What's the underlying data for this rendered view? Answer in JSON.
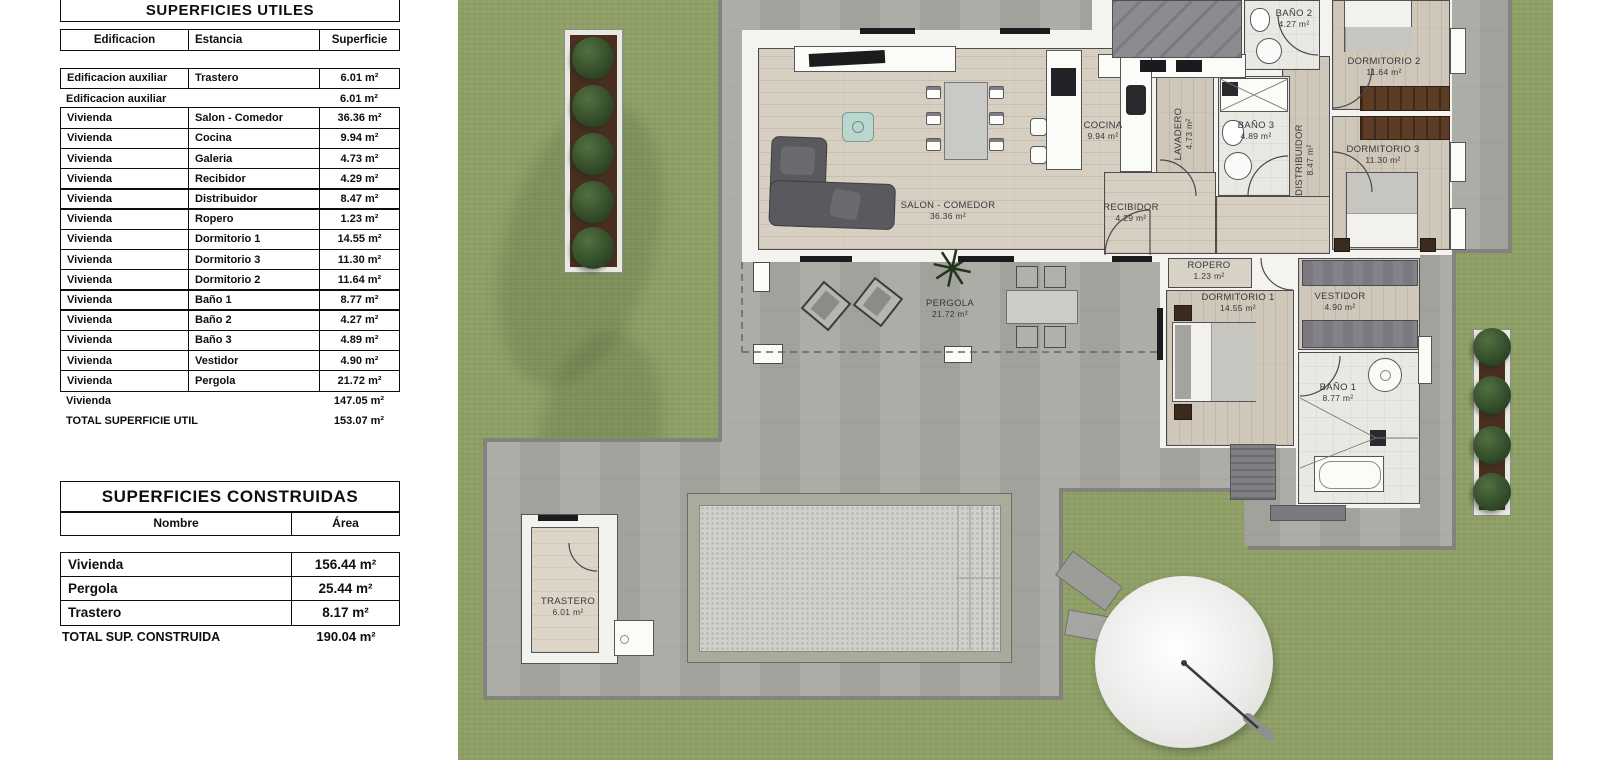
{
  "tables": {
    "utiles": {
      "title": "SUPERFICIES UTILES",
      "col1": "Edificacion",
      "col2": "Estancia",
      "col3": "Superficie",
      "group1": [
        {
          "b": "Edificacion auxiliar",
          "e": "Trastero",
          "s": "6.01 m²"
        }
      ],
      "sub1": {
        "b": "Edificacion auxiliar",
        "s": "6.01 m²"
      },
      "group2": [
        {
          "b": "Vivienda",
          "e": "Salon - Comedor",
          "s": "36.36 m²"
        },
        {
          "b": "Vivienda",
          "e": "Cocina",
          "s": "9.94 m²"
        },
        {
          "b": "Vivienda",
          "e": "Galeria",
          "s": "4.73 m²"
        },
        {
          "b": "Vivienda",
          "e": "Recibidor",
          "s": "4.29 m²"
        },
        {
          "b": "Vivienda",
          "e": "Distribuidor",
          "s": "8.47 m²"
        },
        {
          "b": "Vivienda",
          "e": "Ropero",
          "s": "1.23 m²"
        },
        {
          "b": "Vivienda",
          "e": "Dormitorio 1",
          "s": "14.55 m²"
        },
        {
          "b": "Vivienda",
          "e": "Dormitorio 3",
          "s": "11.30 m²"
        },
        {
          "b": "Vivienda",
          "e": "Dormitorio 2",
          "s": "11.64 m²"
        },
        {
          "b": "Vivienda",
          "e": "Baño 1",
          "s": "8.77 m²"
        },
        {
          "b": "Vivienda",
          "e": "Baño 2",
          "s": "4.27 m²"
        },
        {
          "b": "Vivienda",
          "e": "Baño 3",
          "s": "4.89 m²"
        },
        {
          "b": "Vivienda",
          "e": "Vestidor",
          "s": "4.90 m²"
        },
        {
          "b": "Vivienda",
          "e": "Pergola",
          "s": "21.72 m²"
        }
      ],
      "sub2": {
        "b": "Vivienda",
        "s": "147.05 m²"
      },
      "total": {
        "b": "TOTAL SUPERFICIE UTIL",
        "s": "153.07 m²"
      }
    },
    "construidas": {
      "title": "SUPERFICIES CONSTRUIDAS",
      "col1": "Nombre",
      "col2": "Área",
      "rows": [
        {
          "n": "Vivienda",
          "a": "156.44 m²"
        },
        {
          "n": "Pergola",
          "a": "25.44 m²"
        },
        {
          "n": "Trastero",
          "a": "8.17 m²"
        }
      ],
      "total": {
        "b": "TOTAL SUP. CONSTRUIDA",
        "s": "190.04 m²"
      }
    }
  },
  "plan": {
    "rooms": {
      "salon": {
        "name": "SALON - COMEDOR",
        "area": "36.36 m²"
      },
      "cocina": {
        "name": "COCINA",
        "area": "9.94 m²"
      },
      "recibidor": {
        "name": "RECIBIDOR",
        "area": "4.29 m²"
      },
      "lavadero": {
        "name": "LAVADERO",
        "area": "4.73 m²"
      },
      "distribuidor": {
        "name": "DISTRIBUIDOR",
        "area": "8.47 m²"
      },
      "bano2": {
        "name": "BAÑO 2",
        "area": "4.27 m²"
      },
      "bano3": {
        "name": "BAÑO 3",
        "area": "4.89 m²"
      },
      "dorm2": {
        "name": "DORMITORIO 2",
        "area": "11.64 m²"
      },
      "dorm3": {
        "name": "DORMITORIO 3",
        "area": "11.30 m²"
      },
      "ropero": {
        "name": "ROPERO",
        "area": "1.23 m²"
      },
      "dorm1": {
        "name": "DORMITORIO 1",
        "area": "14.55 m²"
      },
      "vestidor": {
        "name": "VESTIDOR",
        "area": "4.90 m²"
      },
      "bano1": {
        "name": "BAÑO 1",
        "area": "8.77 m²"
      },
      "pergola": {
        "name": "PERGOLA",
        "area": "21.72 m²"
      },
      "trastero": {
        "name": "TRASTERO",
        "area": "6.01 m²"
      }
    },
    "colors": {
      "grass": "#8fa066",
      "terrace": "#a9a9a3",
      "wood_floor": "#d6cfc2",
      "wall": "#f4f3f0",
      "tree": "#2c4425",
      "wardrobe": "#5d3c25"
    }
  }
}
